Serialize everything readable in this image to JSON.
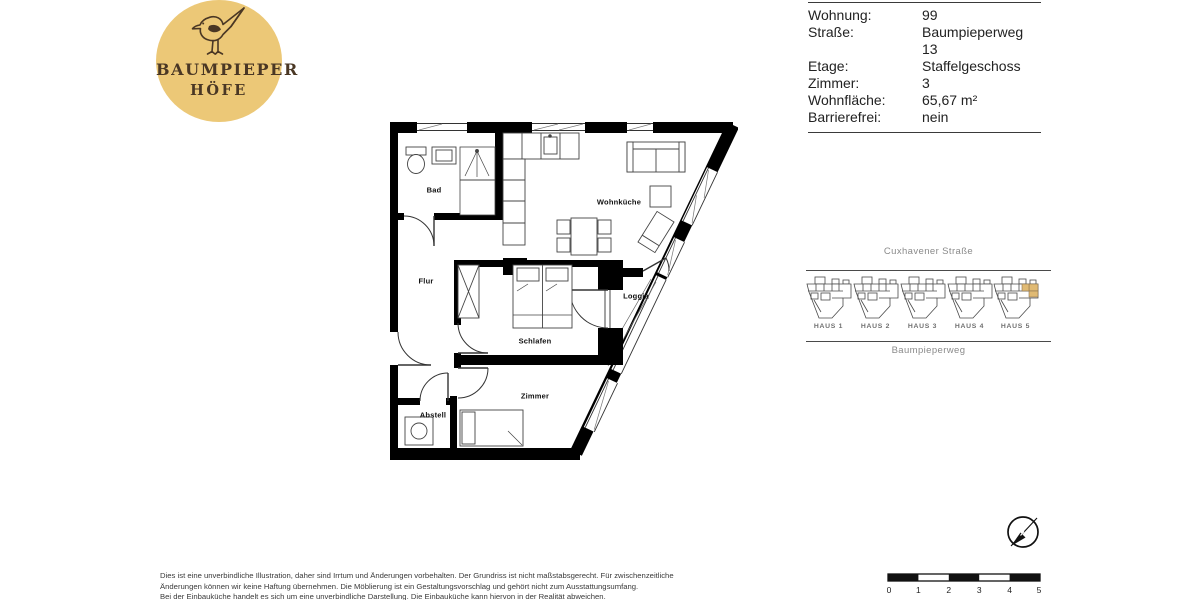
{
  "logo": {
    "icon": "bird-icon",
    "line1": "Baumpieper",
    "line2": "Höfe"
  },
  "info": {
    "rows": [
      {
        "label": "Wohnung:",
        "value": "99"
      },
      {
        "label": "Straße:",
        "value": "Baumpieperweg 13"
      },
      {
        "label": "Etage:",
        "value": "Staffelgeschoss"
      },
      {
        "label": "Zimmer:",
        "value": "3"
      },
      {
        "label": "Wohnfläche:",
        "value": "65,67 m²"
      },
      {
        "label": "Barrierefrei:",
        "value": "nein"
      }
    ]
  },
  "floor_plan": {
    "rooms": [
      {
        "name": "Bad"
      },
      {
        "name": "Flur"
      },
      {
        "name": "Wohnküche"
      },
      {
        "name": "Schlafen"
      },
      {
        "name": "Loggia"
      },
      {
        "name": "Zimmer"
      },
      {
        "name": "Abstell"
      }
    ]
  },
  "site_plan": {
    "street_top": "Cuxhavener Straße",
    "street_bottom": "Baumpieperweg",
    "houses": [
      "HAUS 1",
      "HAUS 2",
      "HAUS 3",
      "HAUS 4",
      "HAUS 5"
    ],
    "highlighted_house": "HAUS 5"
  },
  "scale_bar": {
    "ticks": [
      "0",
      "1",
      "2",
      "3",
      "4",
      "5"
    ]
  },
  "disclaimer": {
    "line1": "Dies ist eine unverbindliche Illustration, daher sind Irrtum und Änderungen vorbehalten. Der Grundriss ist nicht maßstabsgerecht. Für zwischenzeitliche",
    "line2": "Änderungen können wir keine Haftung übernehmen. Die Möblierung ist ein Gestaltungsvorschlag und gehört nicht zum Ausstattungsumfang.",
    "line3": "Bei der Einbauküche handelt es sich um eine unverbindliche Darstellung. Die Einbauküche kann hiervon in der Realität abweichen."
  },
  "colors": {
    "accent_tan": "#ECC877",
    "highlight_tan": "#E0BA74",
    "brand_brown": "#4A3724"
  }
}
